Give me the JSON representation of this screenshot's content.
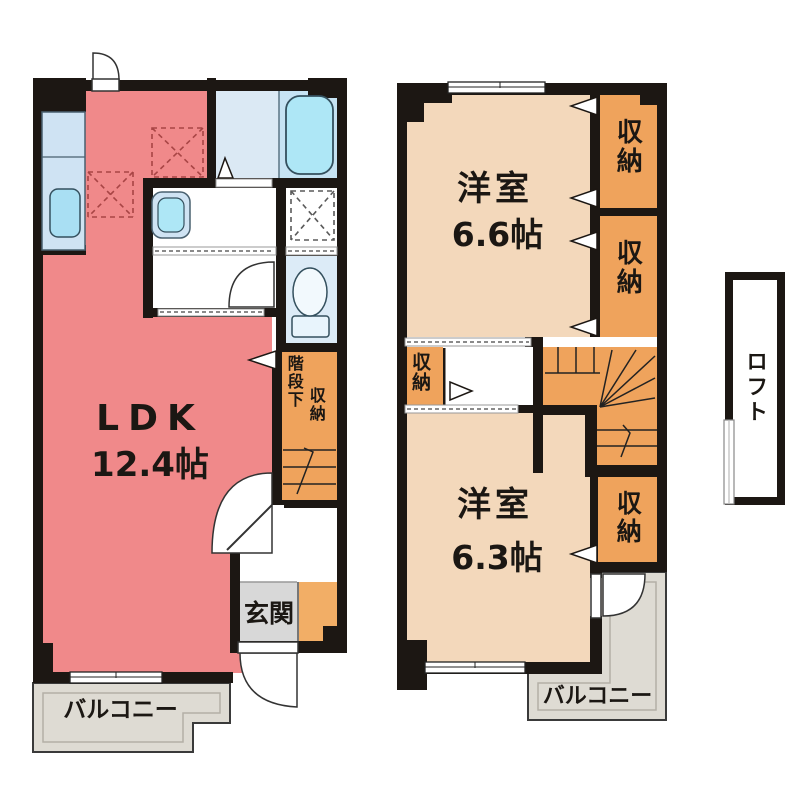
{
  "colors": {
    "wall": "#1c1713",
    "ldk": "#f0898a",
    "western_room": "#f3d8bb",
    "closet": "#efa35c",
    "genkan_side": "#f2ae66",
    "kitchen_counter": "#cfe3f3",
    "bath_left": "#dbe9f4",
    "bath_right": "#c6e3f3",
    "bathtub": "#aee7f6",
    "toilet_room": "#dcebf7",
    "hall": "#ffffff",
    "genkan_floor": "#d8d8d8",
    "balcony": "#dedbd3",
    "loft_fill": "#ffffff"
  },
  "floor1": {
    "ldk_label": "LDK",
    "ldk_size": "12.4帖",
    "genkan": "玄関",
    "balcony": "バルコニー",
    "stair_storage_line1": "階段下",
    "stair_storage_line2": "収納"
  },
  "floor2": {
    "room_top_label": "洋室",
    "room_top_size": "6.6帖",
    "room_bottom_label": "洋室",
    "room_bottom_size": "6.3帖",
    "closet_top": "収納",
    "closet_mid": "収納",
    "closet_small": "収納",
    "closet_bottom": "収納",
    "balcony": "バルコニー"
  },
  "loft": {
    "label": "ロフト"
  }
}
